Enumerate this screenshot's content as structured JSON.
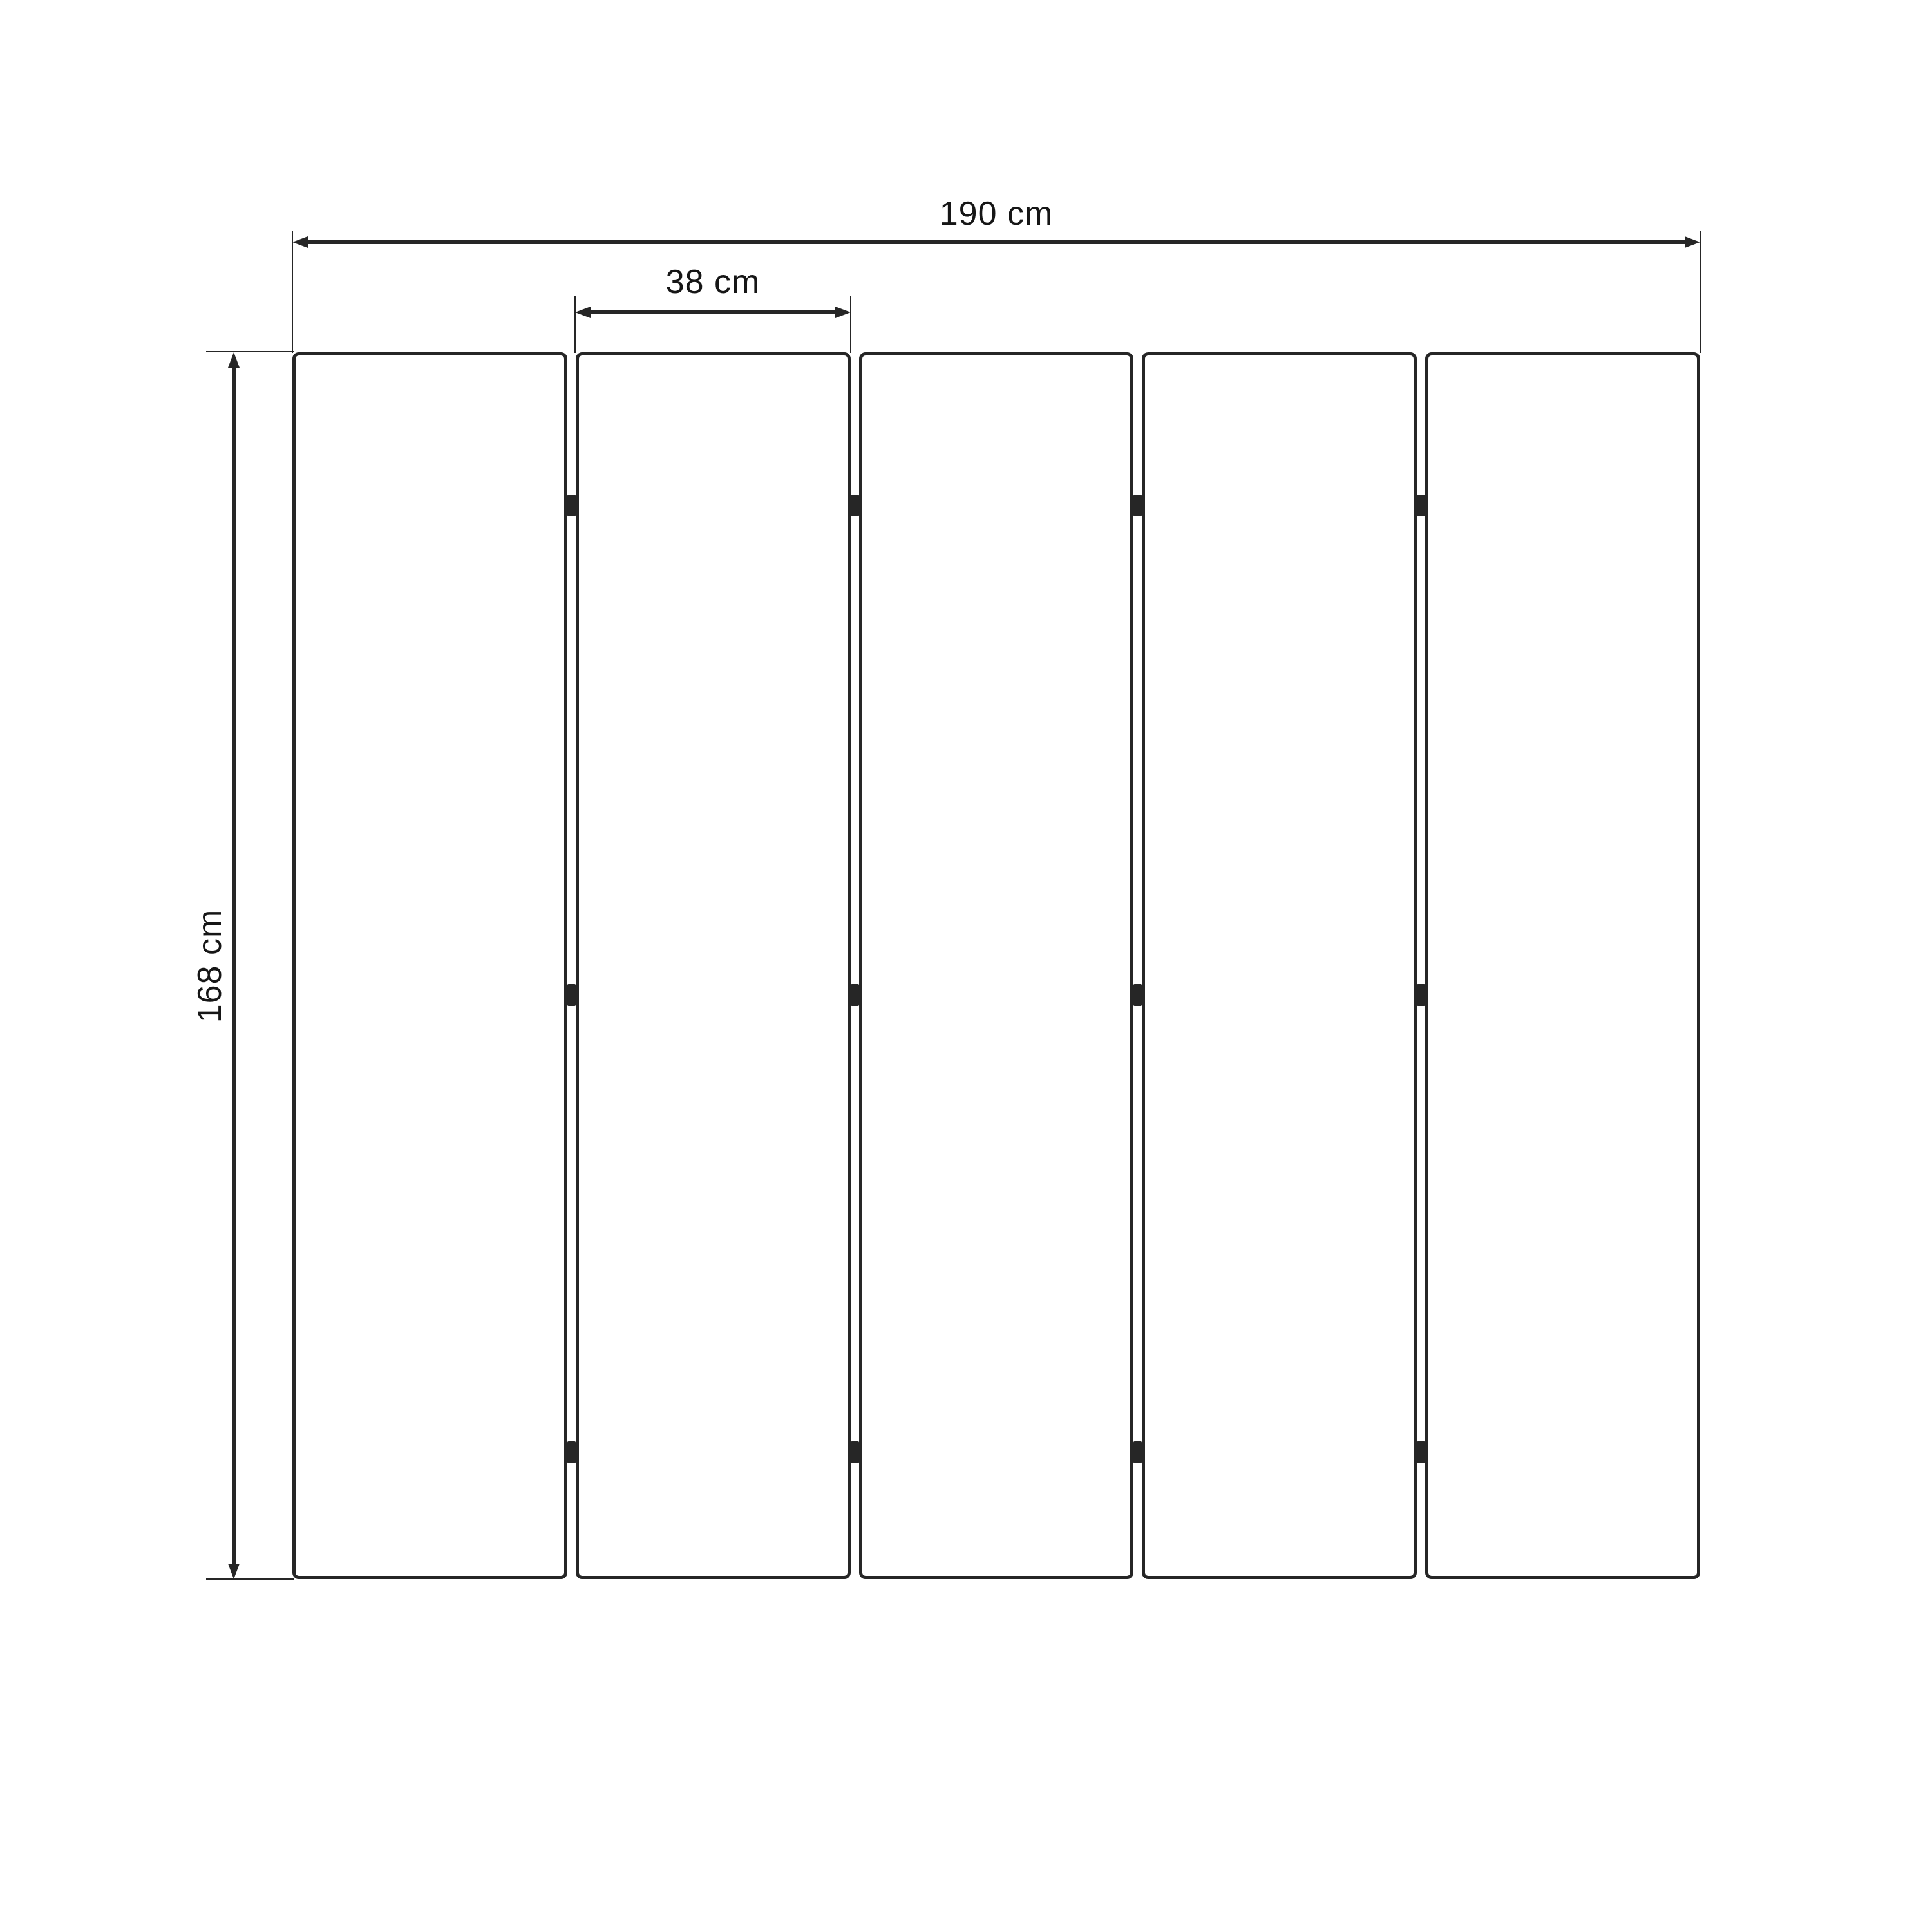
{
  "diagram": {
    "type": "folding-screen-dimension-drawing",
    "panel_count": 5,
    "hinges_per_gap": 3,
    "dimensions": {
      "total_width": {
        "value": 190,
        "unit": "cm",
        "label": "190 cm"
      },
      "panel_width": {
        "value": 38,
        "unit": "cm",
        "label": "38 cm"
      },
      "height": {
        "value": 168,
        "unit": "cm",
        "label": "168 cm"
      }
    },
    "colors": {
      "line": "#262626",
      "text": "#161616",
      "background": "#ffffff"
    }
  }
}
